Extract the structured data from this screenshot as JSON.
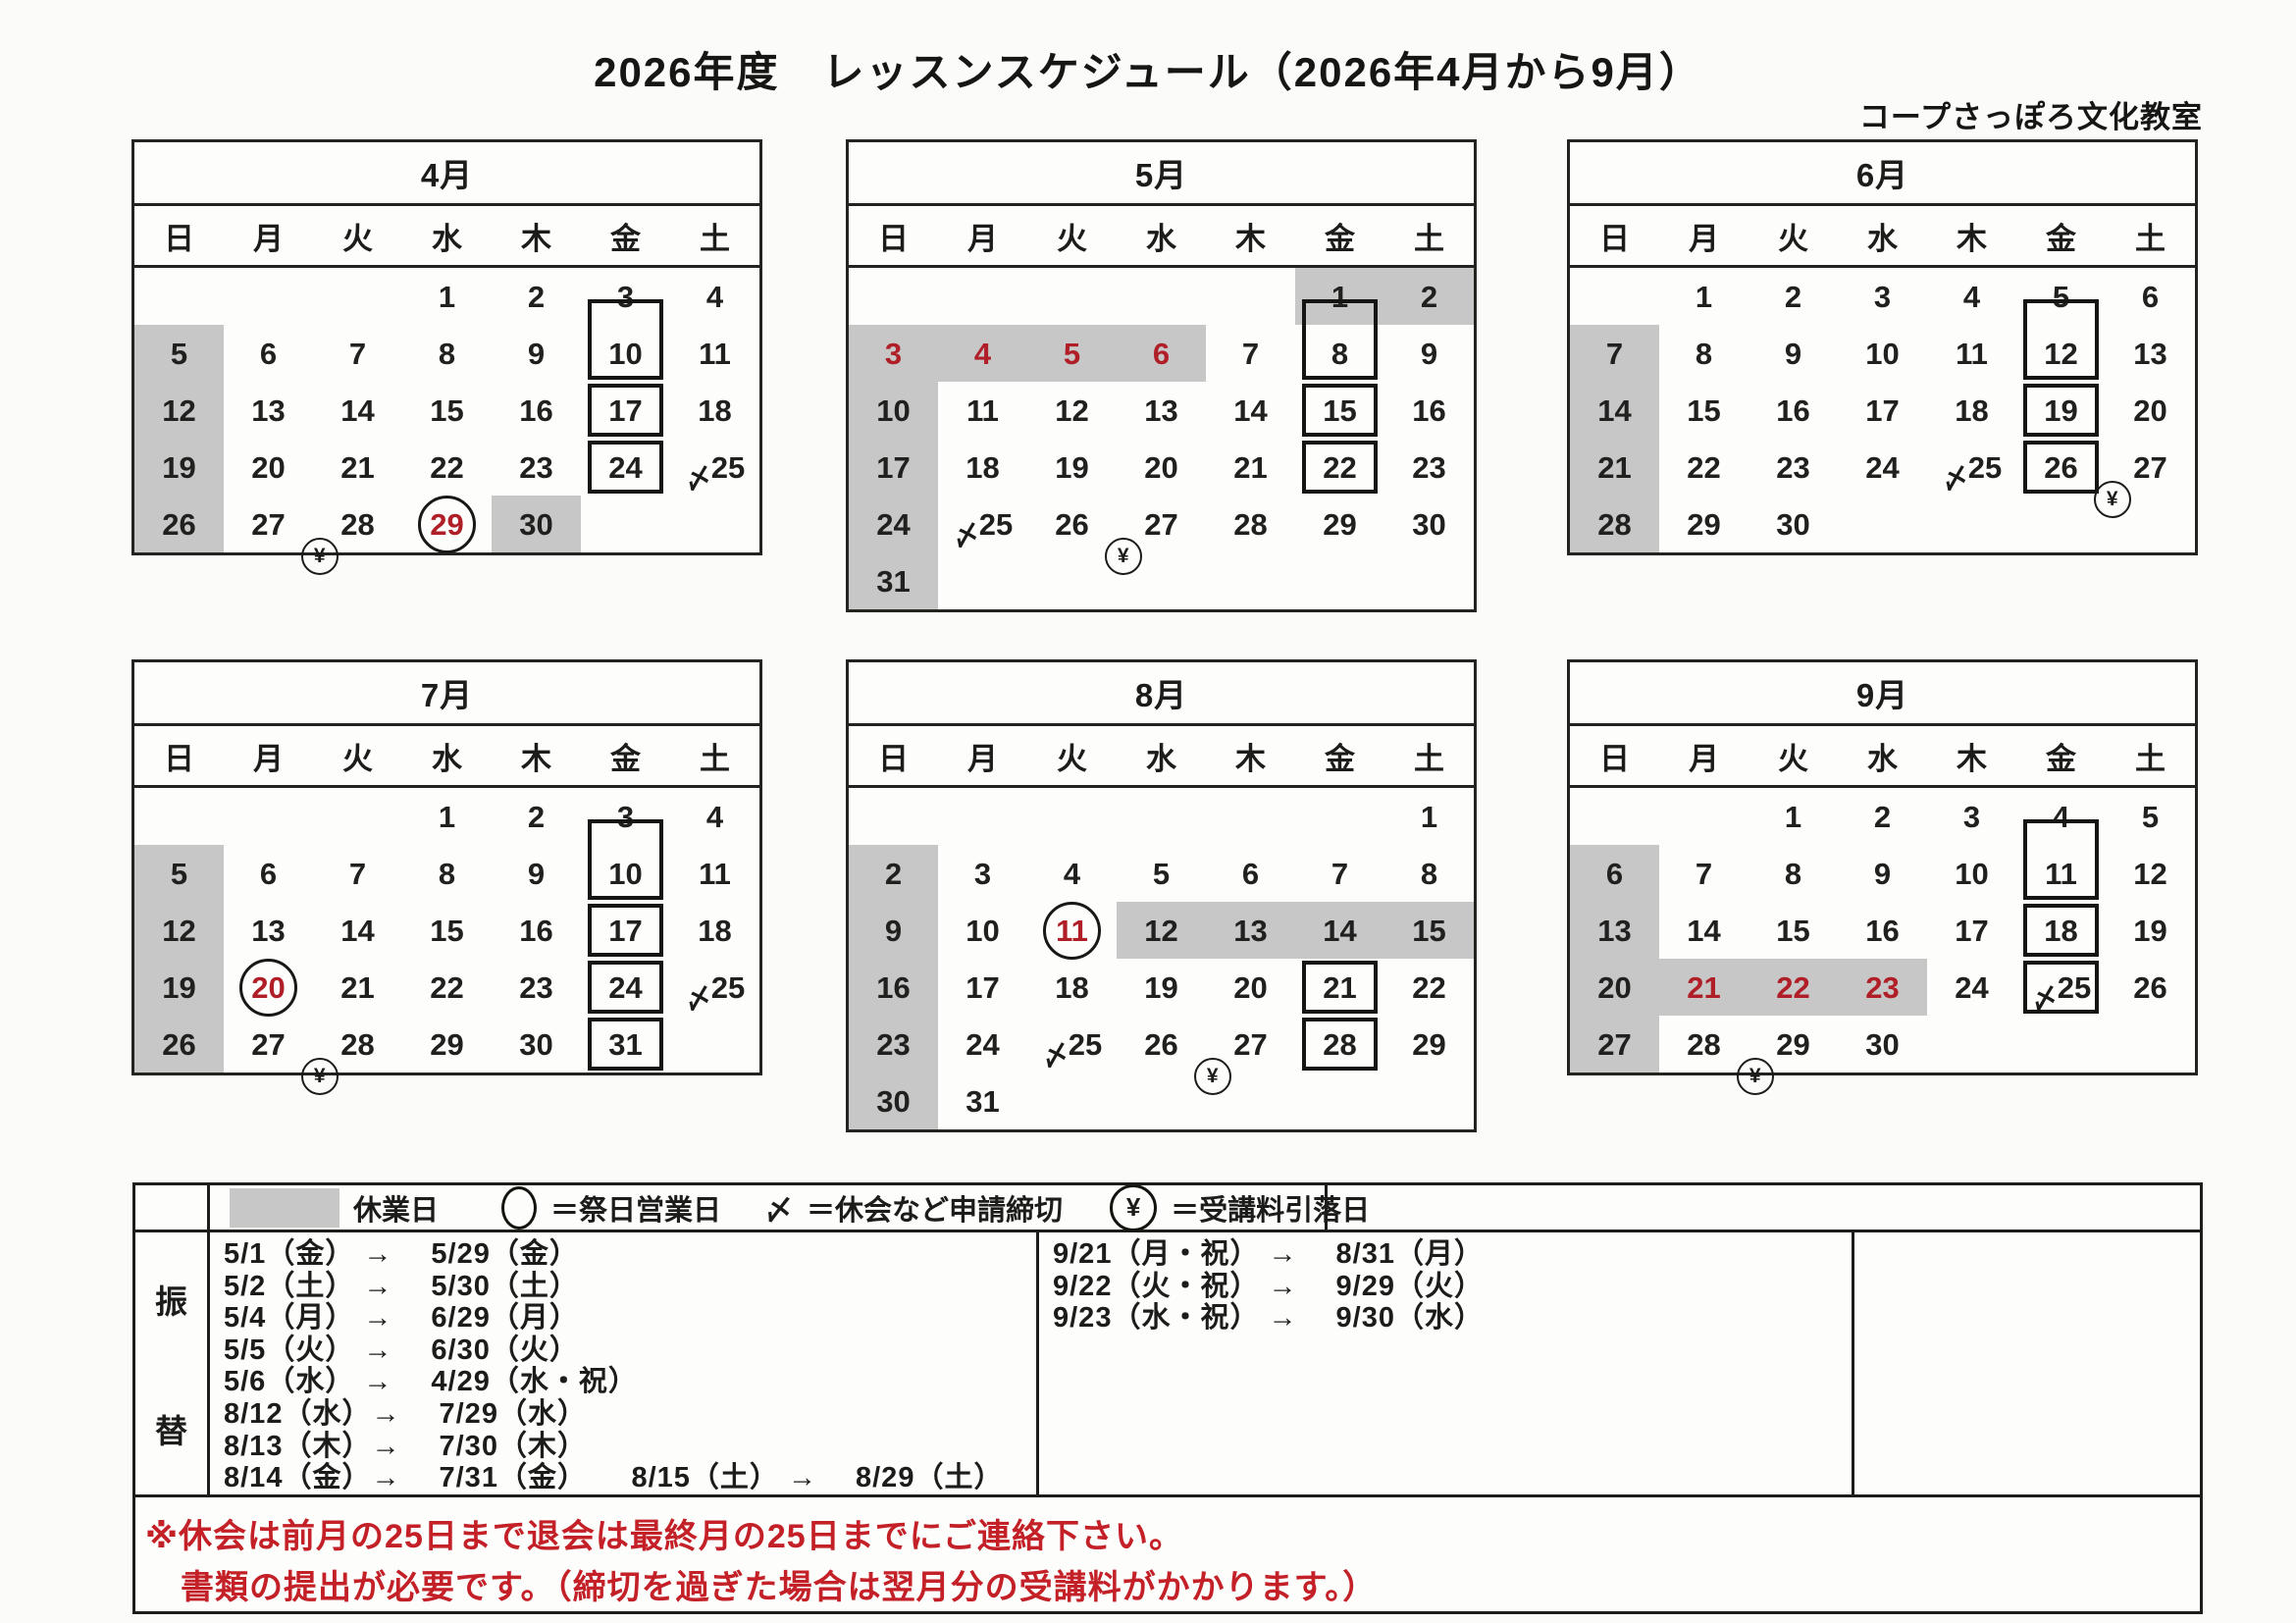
{
  "page": {
    "title": "2026年度　レッスンスケジュール（2026年4月から9月）",
    "subtitle": "コープさっぽろ文化教室"
  },
  "colors": {
    "closed_gray": "#c7c7c7",
    "holiday_red": "#b01f28",
    "notice_red": "#c32027",
    "line_black": "#1d1d1b"
  },
  "weekdays": [
    "日",
    "月",
    "火",
    "水",
    "木",
    "金",
    "土"
  ],
  "months": [
    {
      "name": "4月",
      "weeks": [
        [
          null,
          null,
          null,
          {
            "d": "1"
          },
          {
            "d": "2"
          },
          {
            "d": "3"
          },
          {
            "d": "4"
          }
        ],
        [
          {
            "d": "5",
            "f": "g"
          },
          {
            "d": "6"
          },
          {
            "d": "7"
          },
          {
            "d": "8"
          },
          {
            "d": "9"
          },
          {
            "d": "10",
            "f": "be"
          },
          {
            "d": "11"
          }
        ],
        [
          {
            "d": "12",
            "f": "g"
          },
          {
            "d": "13"
          },
          {
            "d": "14"
          },
          {
            "d": "15"
          },
          {
            "d": "16"
          },
          {
            "d": "17",
            "f": "b"
          },
          {
            "d": "18"
          }
        ],
        [
          {
            "d": "19",
            "f": "g"
          },
          {
            "d": "20"
          },
          {
            "d": "21"
          },
          {
            "d": "22"
          },
          {
            "d": "23"
          },
          {
            "d": "24",
            "f": "b"
          },
          {
            "d": "25",
            "f": "s"
          }
        ],
        [
          {
            "d": "26",
            "f": "g"
          },
          {
            "d": "27",
            "f": "y"
          },
          {
            "d": "28"
          },
          {
            "d": "29",
            "f": "rc"
          },
          {
            "d": "30",
            "f": "g"
          },
          null,
          null
        ]
      ]
    },
    {
      "name": "5月",
      "weeks": [
        [
          null,
          null,
          null,
          null,
          null,
          {
            "d": "1",
            "f": "g"
          },
          {
            "d": "2",
            "f": "g"
          }
        ],
        [
          {
            "d": "3",
            "f": "gr"
          },
          {
            "d": "4",
            "f": "gr"
          },
          {
            "d": "5",
            "f": "gr"
          },
          {
            "d": "6",
            "f": "gr"
          },
          {
            "d": "7"
          },
          {
            "d": "8",
            "f": "be"
          },
          {
            "d": "9"
          }
        ],
        [
          {
            "d": "10",
            "f": "g"
          },
          {
            "d": "11"
          },
          {
            "d": "12"
          },
          {
            "d": "13"
          },
          {
            "d": "14"
          },
          {
            "d": "15",
            "f": "b"
          },
          {
            "d": "16"
          }
        ],
        [
          {
            "d": "17",
            "f": "g"
          },
          {
            "d": "18"
          },
          {
            "d": "19"
          },
          {
            "d": "20"
          },
          {
            "d": "21"
          },
          {
            "d": "22",
            "f": "b"
          },
          {
            "d": "23"
          }
        ],
        [
          {
            "d": "24",
            "f": "g"
          },
          {
            "d": "25",
            "f": "s"
          },
          {
            "d": "26",
            "f": "y"
          },
          {
            "d": "27"
          },
          {
            "d": "28"
          },
          {
            "d": "29"
          },
          {
            "d": "30"
          }
        ],
        [
          {
            "d": "31",
            "f": "g"
          },
          null,
          null,
          null,
          null,
          null,
          null
        ]
      ]
    },
    {
      "name": "6月",
      "weeks": [
        [
          null,
          {
            "d": "1"
          },
          {
            "d": "2"
          },
          {
            "d": "3"
          },
          {
            "d": "4"
          },
          {
            "d": "5"
          },
          {
            "d": "6"
          }
        ],
        [
          {
            "d": "7",
            "f": "g"
          },
          {
            "d": "8"
          },
          {
            "d": "9"
          },
          {
            "d": "10"
          },
          {
            "d": "11"
          },
          {
            "d": "12",
            "f": "be"
          },
          {
            "d": "13"
          }
        ],
        [
          {
            "d": "14",
            "f": "g"
          },
          {
            "d": "15"
          },
          {
            "d": "16"
          },
          {
            "d": "17"
          },
          {
            "d": "18"
          },
          {
            "d": "19",
            "f": "b"
          },
          {
            "d": "20"
          }
        ],
        [
          {
            "d": "21",
            "f": "g"
          },
          {
            "d": "22"
          },
          {
            "d": "23"
          },
          {
            "d": "24"
          },
          {
            "d": "25",
            "f": "s"
          },
          {
            "d": "26",
            "f": "by"
          },
          {
            "d": "27"
          }
        ],
        [
          {
            "d": "28",
            "f": "g"
          },
          {
            "d": "29"
          },
          {
            "d": "30"
          },
          null,
          null,
          null,
          null
        ]
      ]
    },
    {
      "name": "7月",
      "weeks": [
        [
          null,
          null,
          null,
          {
            "d": "1"
          },
          {
            "d": "2"
          },
          {
            "d": "3"
          },
          {
            "d": "4"
          }
        ],
        [
          {
            "d": "5",
            "f": "g"
          },
          {
            "d": "6"
          },
          {
            "d": "7"
          },
          {
            "d": "8"
          },
          {
            "d": "9"
          },
          {
            "d": "10",
            "f": "be"
          },
          {
            "d": "11"
          }
        ],
        [
          {
            "d": "12",
            "f": "g"
          },
          {
            "d": "13"
          },
          {
            "d": "14"
          },
          {
            "d": "15"
          },
          {
            "d": "16"
          },
          {
            "d": "17",
            "f": "b"
          },
          {
            "d": "18"
          }
        ],
        [
          {
            "d": "19",
            "f": "g"
          },
          {
            "d": "20",
            "f": "rc"
          },
          {
            "d": "21"
          },
          {
            "d": "22"
          },
          {
            "d": "23"
          },
          {
            "d": "24",
            "f": "b"
          },
          {
            "d": "25",
            "f": "s"
          }
        ],
        [
          {
            "d": "26",
            "f": "g"
          },
          {
            "d": "27",
            "f": "y"
          },
          {
            "d": "28"
          },
          {
            "d": "29"
          },
          {
            "d": "30"
          },
          {
            "d": "31",
            "f": "b"
          },
          null
        ]
      ]
    },
    {
      "name": "8月",
      "weeks": [
        [
          null,
          null,
          null,
          null,
          null,
          null,
          {
            "d": "1"
          }
        ],
        [
          {
            "d": "2",
            "f": "g"
          },
          {
            "d": "3"
          },
          {
            "d": "4"
          },
          {
            "d": "5"
          },
          {
            "d": "6"
          },
          {
            "d": "7"
          },
          {
            "d": "8"
          }
        ],
        [
          {
            "d": "9",
            "f": "g"
          },
          {
            "d": "10"
          },
          {
            "d": "11",
            "f": "rc"
          },
          {
            "d": "12",
            "f": "g"
          },
          {
            "d": "13",
            "f": "g"
          },
          {
            "d": "14",
            "f": "g"
          },
          {
            "d": "15",
            "f": "g"
          }
        ],
        [
          {
            "d": "16",
            "f": "g"
          },
          {
            "d": "17"
          },
          {
            "d": "18"
          },
          {
            "d": "19"
          },
          {
            "d": "20"
          },
          {
            "d": "21",
            "f": "b"
          },
          {
            "d": "22"
          }
        ],
        [
          {
            "d": "23",
            "f": "g"
          },
          {
            "d": "24"
          },
          {
            "d": "25",
            "f": "s"
          },
          {
            "d": "26",
            "f": "y"
          },
          {
            "d": "27"
          },
          {
            "d": "28",
            "f": "b"
          },
          {
            "d": "29"
          }
        ],
        [
          {
            "d": "30",
            "f": "g"
          },
          {
            "d": "31"
          },
          null,
          null,
          null,
          null,
          null
        ]
      ]
    },
    {
      "name": "9月",
      "weeks": [
        [
          null,
          null,
          {
            "d": "1"
          },
          {
            "d": "2"
          },
          {
            "d": "3"
          },
          {
            "d": "4"
          },
          {
            "d": "5"
          }
        ],
        [
          {
            "d": "6",
            "f": "g"
          },
          {
            "d": "7"
          },
          {
            "d": "8"
          },
          {
            "d": "9"
          },
          {
            "d": "10"
          },
          {
            "d": "11",
            "f": "be"
          },
          {
            "d": "12"
          }
        ],
        [
          {
            "d": "13",
            "f": "g"
          },
          {
            "d": "14"
          },
          {
            "d": "15"
          },
          {
            "d": "16"
          },
          {
            "d": "17"
          },
          {
            "d": "18",
            "f": "b"
          },
          {
            "d": "19"
          }
        ],
        [
          {
            "d": "20",
            "f": "g"
          },
          {
            "d": "21",
            "f": "gr"
          },
          {
            "d": "22",
            "f": "gr"
          },
          {
            "d": "23",
            "f": "gr"
          },
          {
            "d": "24"
          },
          {
            "d": "25",
            "f": "bs"
          },
          {
            "d": "26"
          }
        ],
        [
          {
            "d": "27",
            "f": "g"
          },
          {
            "d": "28",
            "f": "y"
          },
          {
            "d": "29"
          },
          {
            "d": "30"
          },
          null,
          null,
          null
        ]
      ]
    }
  ],
  "legend": {
    "closed_label": "休業日",
    "circle_label": "＝祭日営業日",
    "shime_symbol": "〆",
    "shime_label": "＝休会など申請締切",
    "yen_symbol": "¥",
    "yen_label": "＝受講料引落日"
  },
  "transfers": {
    "header": "振替",
    "left": [
      "5/1（金） →　 5/29（金）",
      "5/2（土） →　 5/30（土）",
      "5/4（月） →　 6/29（月）",
      "5/5（火） →　 6/30（火）",
      "5/6（水） →　 4/29（水・祝）",
      "8/12（水）→　 7/29（水）",
      "8/13（木）→　 7/30（木）",
      "8/14（金）→　 7/31（金）　　8/15（土） →　 8/29（土）"
    ],
    "right": [
      "9/21（月・祝） →　 8/31（月）",
      "9/22（火・祝） →　 9/29（火）",
      "9/23（水・祝） →　 9/30（水）"
    ]
  },
  "notice": {
    "line1": "※休会は前月の25日まで退会は最終月の25日までにご連絡下さい。",
    "line2": "書類の提出が必要です。（締切を過ぎた場合は翌月分の受講料がかかります。）"
  }
}
